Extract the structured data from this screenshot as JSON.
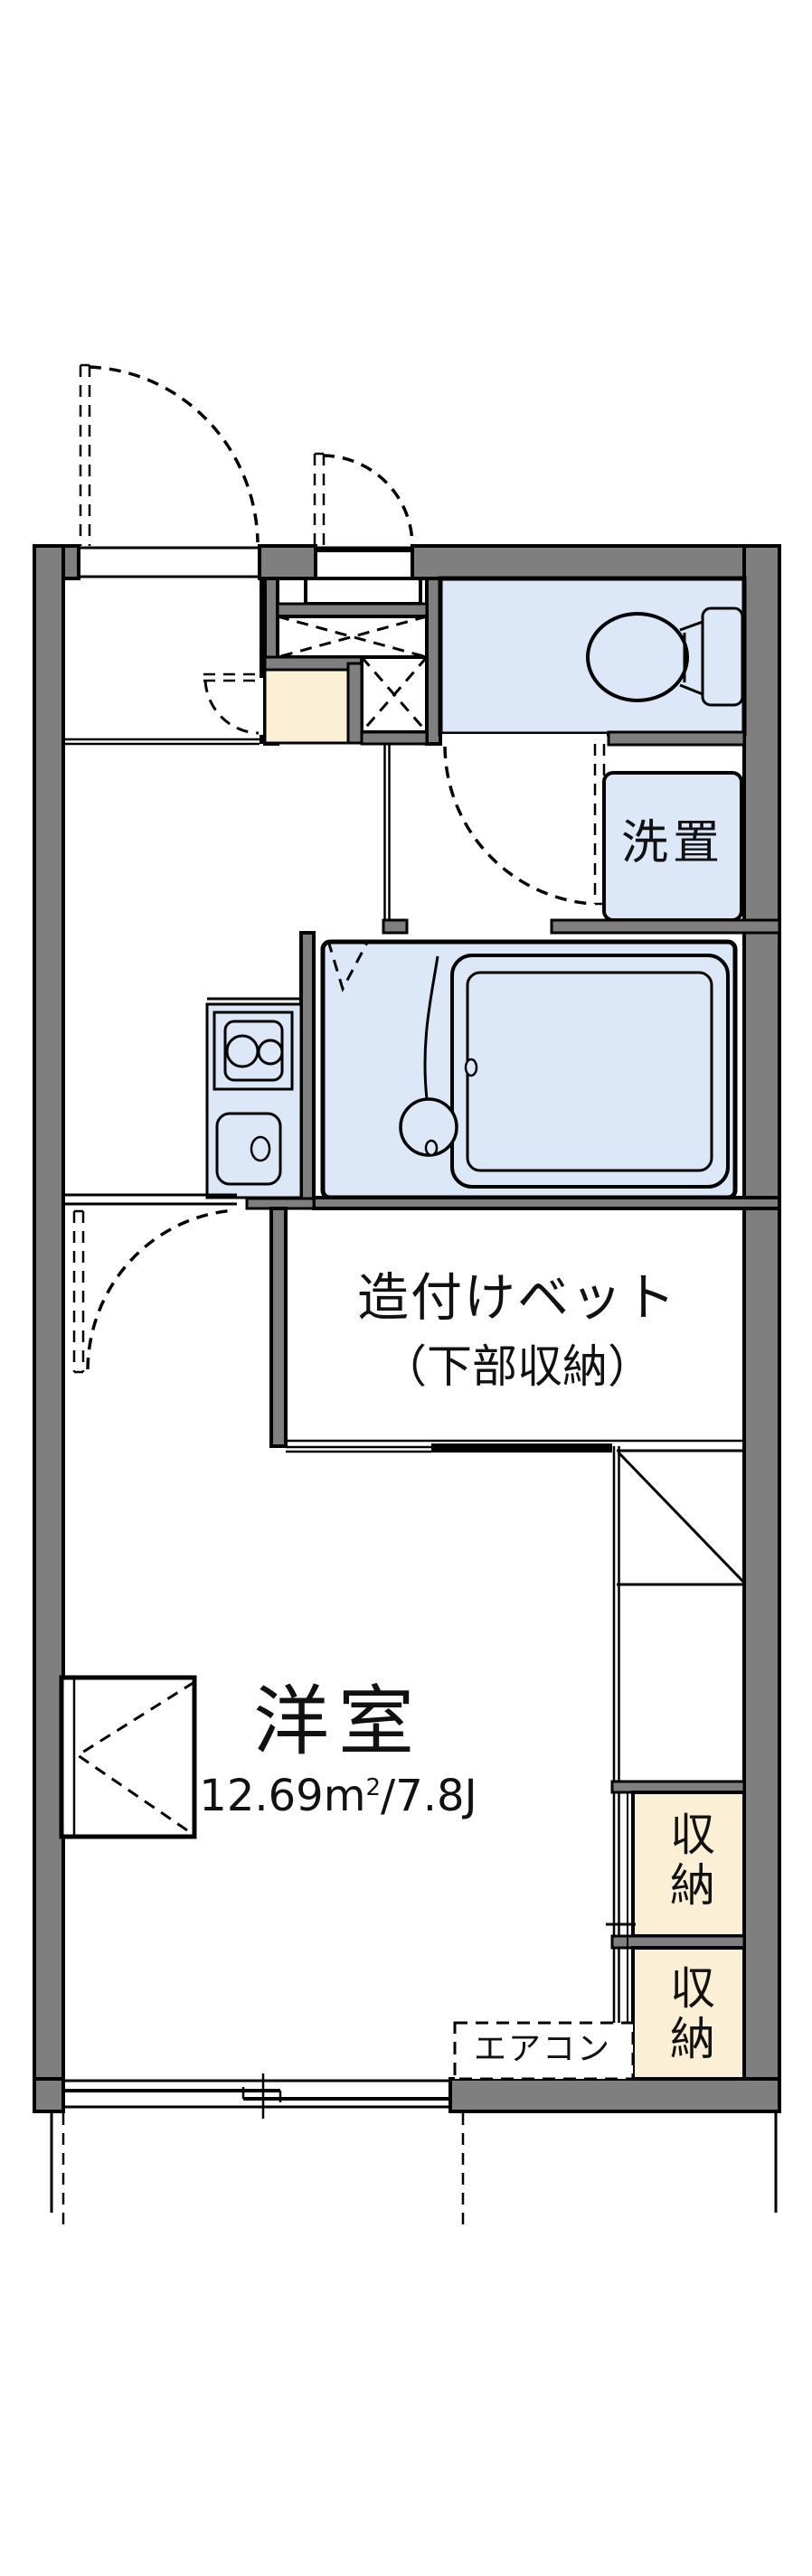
{
  "colors": {
    "wall": "#7f7f7f",
    "floor": "#dce8f7",
    "storage": "#fbf0d6",
    "line": "#000000"
  },
  "labels": {
    "washer": "洗置",
    "bed_line1": "造付けベット",
    "bed_line2": "（下部収納）",
    "room_name": "洋室",
    "room_area_prefix": "12.69m",
    "room_area_sup": "2",
    "room_area_suffix": "/7.8J",
    "storage_upper": "収納",
    "storage_lower": "収納",
    "aircon": "エアコン"
  }
}
